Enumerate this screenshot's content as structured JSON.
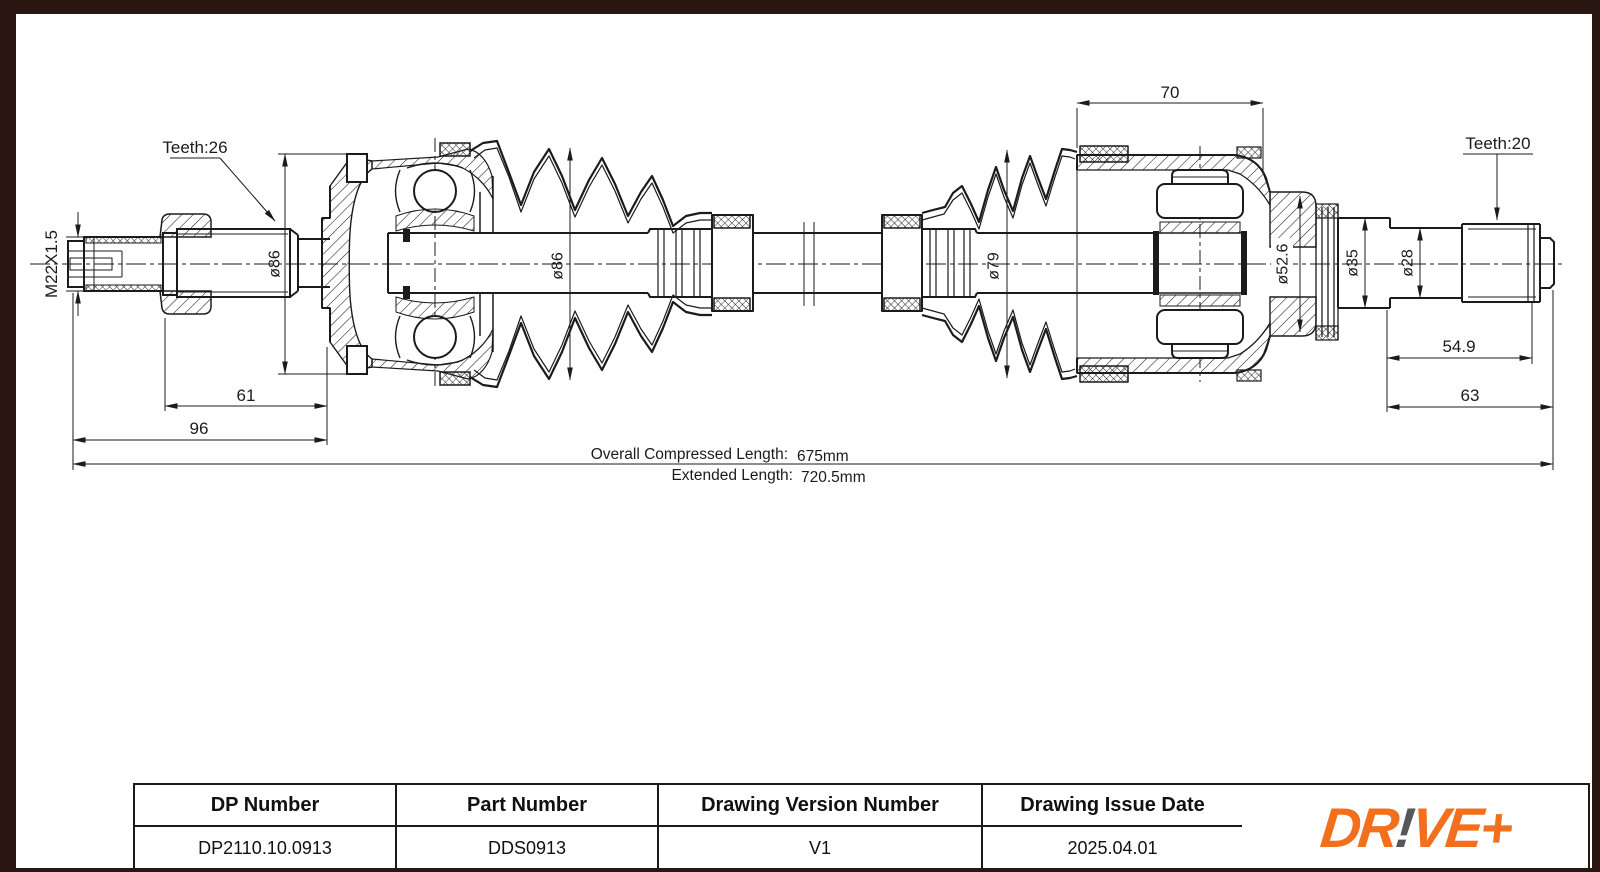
{
  "page": {
    "bg": "#ffffff",
    "border_color": "#2b1712"
  },
  "drawing": {
    "labels": {
      "teeth_left": "Teeth:26",
      "teeth_right": "Teeth:20",
      "thread_spec": "M22X1.5",
      "dia_joint_left": "ø86",
      "dia_boot_left": "ø86",
      "dia_boot_right": "ø79",
      "dia_housing_right": "ø52.6",
      "dia_bearing_seat": "ø35",
      "dia_shaft_end": "ø28",
      "dim_housing_length": "70",
      "dim_spline_to_joint": "61",
      "dim_stub_length": "96",
      "dim_spline_length": "54.9",
      "dim_stub_right": "63",
      "overall_label": "Overall Compressed Length:",
      "overall_value": "675mm",
      "extended_label": "Extended Length:",
      "extended_value": "720.5mm"
    }
  },
  "title_block": {
    "columns": [
      {
        "header": "DP Number",
        "value": "DP2110.10.0913"
      },
      {
        "header": "Part Number",
        "value": "DDS0913"
      },
      {
        "header": "Drawing Version Number",
        "value": "V1"
      },
      {
        "header": "Drawing Issue Date",
        "value": "2025.04.01"
      }
    ],
    "logo": {
      "part1": "DR",
      "part2": "!",
      "part3": "VE+",
      "orange": "#F2701D",
      "gray": "#57575B"
    }
  }
}
